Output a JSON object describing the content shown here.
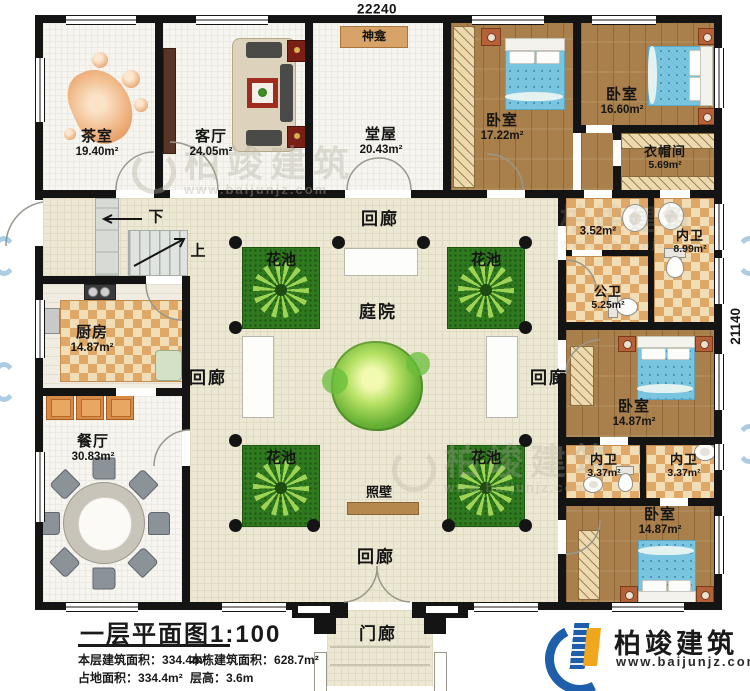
{
  "dimensions": {
    "width_top": "22240",
    "height_right": "21140"
  },
  "labels": {
    "corridor": "回廊",
    "courtyard": "庭院",
    "flower_bed": "花池",
    "screen_wall": "照壁",
    "porch": "门廊",
    "shrine": "神龛",
    "stair_up": "上",
    "stair_down": "下"
  },
  "rooms": {
    "tea_room": {
      "name": "茶室",
      "area": "19.40m²"
    },
    "living_room": {
      "name": "客厅",
      "area": "24.05m²"
    },
    "main_hall": {
      "name": "堂屋",
      "area": "20.43m²"
    },
    "bedroom_top": {
      "name": "卧室",
      "area": "17.22m²"
    },
    "bedroom_topright": {
      "name": "卧室",
      "area": "16.60m²"
    },
    "cloakroom": {
      "name": "衣帽间",
      "area": "5.69m²"
    },
    "bath_unnamed": {
      "area": "3.52m²"
    },
    "ensuite_large": {
      "name": "内卫",
      "area": "8.99m²"
    },
    "public_bath": {
      "name": "公卫",
      "area": "5.25m²"
    },
    "bedroom_mid": {
      "name": "卧室",
      "area": "14.87m²"
    },
    "ensuite_left": {
      "name": "内卫",
      "area": "3.37m²"
    },
    "ensuite_right": {
      "name": "内卫",
      "area": "3.37m²"
    },
    "bedroom_bottom": {
      "name": "卧室",
      "area": "14.87m²"
    },
    "kitchen": {
      "name": "厨房",
      "area": "14.87m²"
    },
    "dining_room": {
      "name": "餐厅",
      "area": "30.83m²"
    }
  },
  "title_block": {
    "title": "一层平面图1:100",
    "floor_area_label": "本层建筑面积：",
    "floor_area": "334.4m²",
    "total_area_label": "本栋建筑面积：",
    "total_area": "628.7m²",
    "land_area_label": "占地面积：",
    "land_area": "334.4m²",
    "height_label": "层高：",
    "height": "3.6m"
  },
  "branding": {
    "company": "柏竣建筑",
    "website": "www.baijunjz.com"
  },
  "watermark": {
    "brand": "柏竣建筑",
    "site": "www.baijunjz.com"
  },
  "colors": {
    "wall": "#141414",
    "wood_floor": "#a97f4b",
    "tile_checker": "#dfa866",
    "courtyard_floor": "#ece8d3",
    "flower_bed": "#2f7a1f",
    "bed_blue": "#79c5e0",
    "screen_wall": "#b5894e",
    "logo_blue": "#1e5eaa",
    "logo_orange": "#f0a71d"
  }
}
